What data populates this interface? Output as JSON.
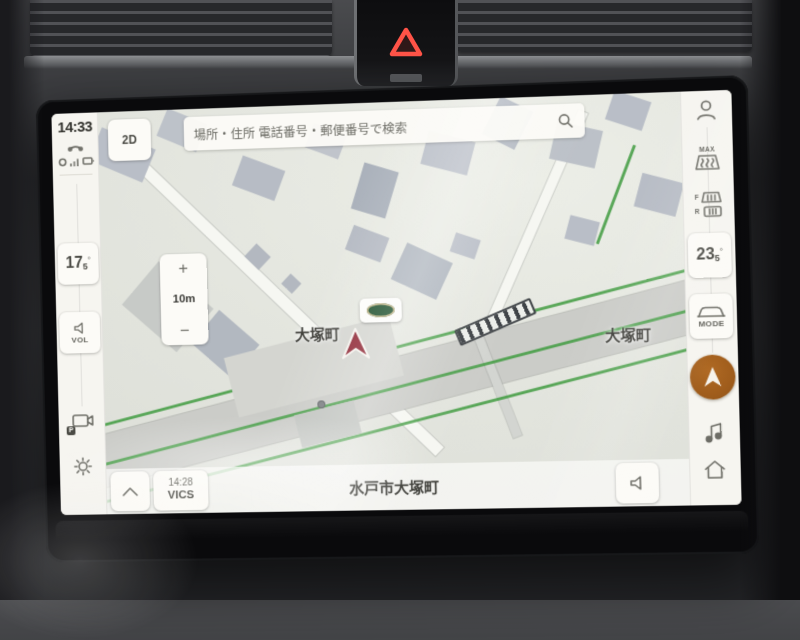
{
  "left_rail": {
    "clock": "14:33",
    "temp_int": "17",
    "temp_frac": "5",
    "temp_unit": "°",
    "volume_label": "VOL",
    "parking_badge": "P"
  },
  "right_rail": {
    "temp_int": "23",
    "temp_frac": "5",
    "temp_unit": "°",
    "mode_label": "MODE",
    "defrost_max_label": "MAX",
    "defrost_front_label": "F",
    "defrost_rear_label": "R"
  },
  "search": {
    "placeholder": "場所・住所 電話番号・郵便番号で検索"
  },
  "map": {
    "view_mode": "2D",
    "zoom_in": "+",
    "scale": "10m",
    "zoom_out": "−",
    "current_area": "大塚町",
    "edge_area": "大塚町",
    "address_bar": "水戸市大塚町",
    "vics_time": "14:28",
    "vics_label": "VICS"
  },
  "icons": {
    "search": "magnifier",
    "profile": "person-silhouette",
    "defrost_max": "windshield-heat",
    "defrost_front_rear": "front-rear-window-heat",
    "climate_mode": "car-outline",
    "compass": "navigation-arrow",
    "media": "music-note",
    "home": "house-outline",
    "volume": "speaker",
    "mute": "speaker",
    "parking_camera": "camera-with-p",
    "settings": "gear",
    "phone": "handset",
    "status": "signal-and-battery",
    "hazard": "warning-triangle",
    "expand": "chevron-up",
    "position": "red-nav-arrow",
    "brand_badge": "land-rover-oval"
  },
  "colors": {
    "ui_background": "#f1f0ea",
    "map_background": "#e3e5de",
    "accent_compass": "#a05d1c",
    "position_arrow": "#8e2533",
    "traffic_green": "#3f9b40",
    "badge_green": "#1a4d2a",
    "hazard_red": "#ff5347"
  }
}
